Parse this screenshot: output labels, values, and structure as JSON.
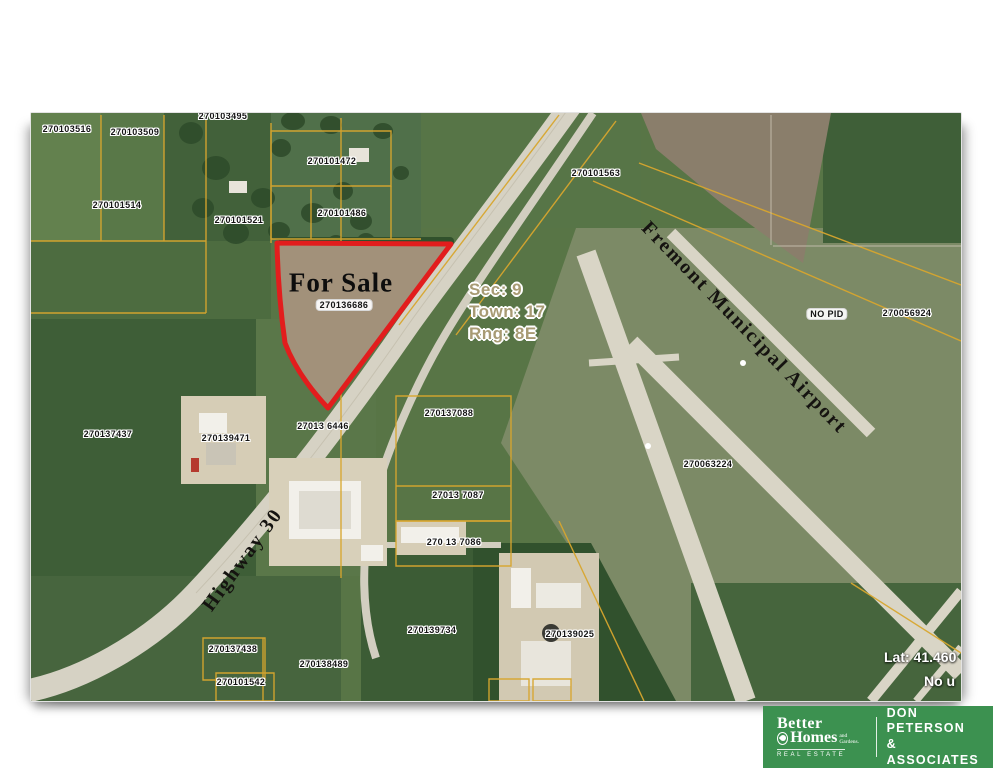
{
  "map": {
    "for_sale_label": "For Sale",
    "section_info": {
      "sec": "Sec: 9",
      "town": "Town: 17",
      "rng": "Rng: 8E"
    },
    "airport_label": "Fremont Municipal Airport",
    "highway_label": "Highway 30",
    "lat_label": "Lat: 41.460",
    "no_use_label": "No u",
    "parcel_labels": [
      {
        "text": "270103516",
        "x": 36,
        "y": 16
      },
      {
        "text": "270103509",
        "x": 104,
        "y": 19
      },
      {
        "text": "270103495",
        "x": 192,
        "y": 3
      },
      {
        "text": "270101472",
        "x": 301,
        "y": 48
      },
      {
        "text": "270101514",
        "x": 86,
        "y": 92
      },
      {
        "text": "270101521",
        "x": 208,
        "y": 107
      },
      {
        "text": "270101486",
        "x": 311,
        "y": 100
      },
      {
        "text": "270101563",
        "x": 565,
        "y": 60
      },
      {
        "text": "270136686",
        "x": 313,
        "y": 192,
        "pill": true
      },
      {
        "text": "NO PID",
        "x": 796,
        "y": 201,
        "pill": true
      },
      {
        "text": "270056924",
        "x": 876,
        "y": 200
      },
      {
        "text": "270137437",
        "x": 77,
        "y": 321
      },
      {
        "text": "270139471",
        "x": 195,
        "y": 325
      },
      {
        "text": "27013 6446",
        "x": 292,
        "y": 313
      },
      {
        "text": "270137088",
        "x": 418,
        "y": 300
      },
      {
        "text": "270063224",
        "x": 677,
        "y": 351
      },
      {
        "text": "27013 7087",
        "x": 427,
        "y": 382
      },
      {
        "text": "270 13 7086",
        "x": 423,
        "y": 429
      },
      {
        "text": "270139734",
        "x": 401,
        "y": 517
      },
      {
        "text": "270139025",
        "x": 539,
        "y": 521
      },
      {
        "text": "270137438",
        "x": 202,
        "y": 536
      },
      {
        "text": "270138489",
        "x": 293,
        "y": 551
      },
      {
        "text": "270101542",
        "x": 210,
        "y": 569
      }
    ]
  },
  "branding": {
    "bhg_line1": "Better",
    "bhg_line2": "Homes",
    "bhg_line2_small": "and Gardens.",
    "bhg_sub": "REAL ESTATE",
    "agency_line1": "DON PETERSON",
    "agency_line2": "& ASSOCIATES"
  },
  "colors": {
    "logo_green": "#3c9150",
    "for_sale_outline": "#e21d1d",
    "parcel_line_gold": "#d8a62e",
    "field_green": "#587546",
    "road_gray": "#d6d2c4"
  }
}
